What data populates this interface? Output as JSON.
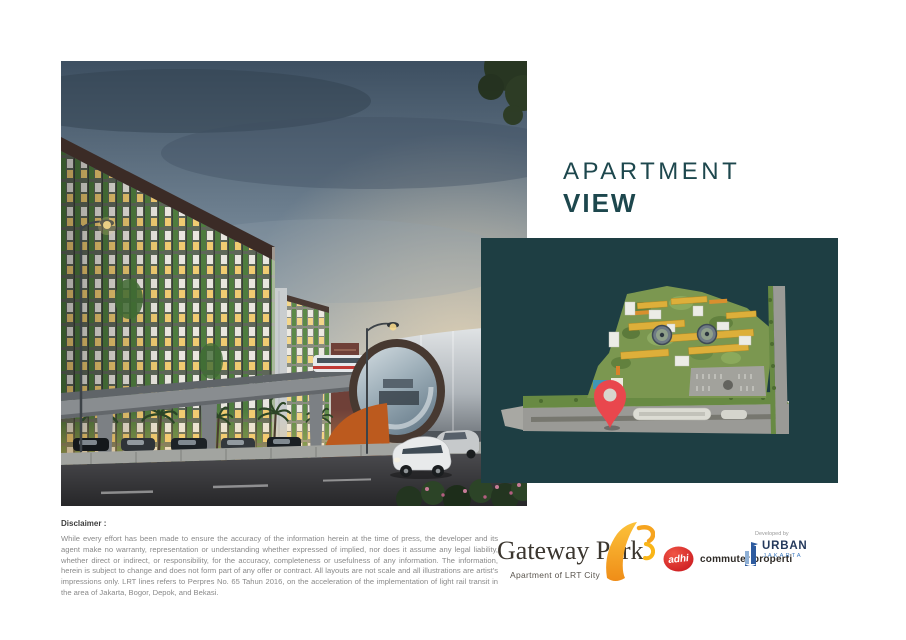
{
  "title": {
    "line1": "APARTMENT",
    "line2": "VIEW"
  },
  "disclaimer": {
    "heading": "Disclaimer :",
    "body": "While every effort has been made to ensure the accuracy of the information herein at the time of press, the developer and its agent make no warranty, representation or understanding whether expressed of implied, nor does it assume any legal liability, whether direct or indirect, or responsibility, for the accuracy, completeness or usefulness of any information. The information, herein is subject to change and does not form part of any offer or contract. All layouts are not scale and all illustrations are artist's impressions only. LRT lines refers to Perpres No. 65 Tahun 2016, on the acceleration of the implementation of light rail transit in the area of Jakarta, Bogor, Depok, and Bekasi."
  },
  "footer": {
    "gateway_park": {
      "name": "Gateway Park",
      "tagline": "Apartment of LRT City"
    },
    "adhi": {
      "badge": "adhi",
      "label": "commuter properti"
    },
    "developed_by": "Developed by",
    "urban": {
      "name": "URBAN",
      "city": "JAKARTA"
    }
  },
  "icons": {
    "location_pin": "map-location-pin",
    "gateway_bird": "gateway-park-bird-mark",
    "urban_building": "urban-jakarta-building-mark"
  },
  "colors": {
    "teal-panel": "#1e3e43",
    "title-color": "#1d474d",
    "pin-red": "#e9474d",
    "adhi-red": "#e2231a",
    "urban-navy": "#24395c",
    "urban-blue": "#3f7cc0",
    "gateway-orange": "#f6a41f",
    "disclaimer-grey": "#8a8a8a"
  }
}
